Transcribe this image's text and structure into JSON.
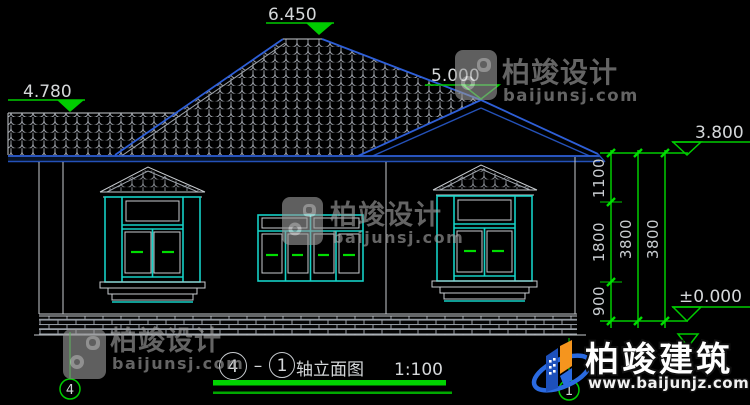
{
  "watermark": {
    "brand": "柏竣设计",
    "site": "baijunsj.com"
  },
  "brand_logo": {
    "name": "柏竣建筑",
    "site": "www.baijunjz.com"
  },
  "elevation_markers": {
    "left_eave": "4.780",
    "ridge": "6.450",
    "gable_peak": "5.000",
    "right_eave": "3.800",
    "ground_level": "±0.000"
  },
  "dimensions": {
    "seg_1100": "1100",
    "seg_1800": "1800",
    "seg_900": "900",
    "total_3800_inner": "3800",
    "total_3800_outer": "3800"
  },
  "title_block": {
    "axis_from": "4",
    "separator": "–",
    "axis_to": "1",
    "name": "轴立面图",
    "scale": "1:100"
  },
  "axis_bubbles": {
    "left": "4",
    "right": "1"
  },
  "colors": {
    "background": "#000000",
    "roof_blue": "#2e5fd7",
    "window_cyan": "#15d0c5",
    "dimension_green": "#00cc00",
    "line_white": "#c8ccd0"
  }
}
